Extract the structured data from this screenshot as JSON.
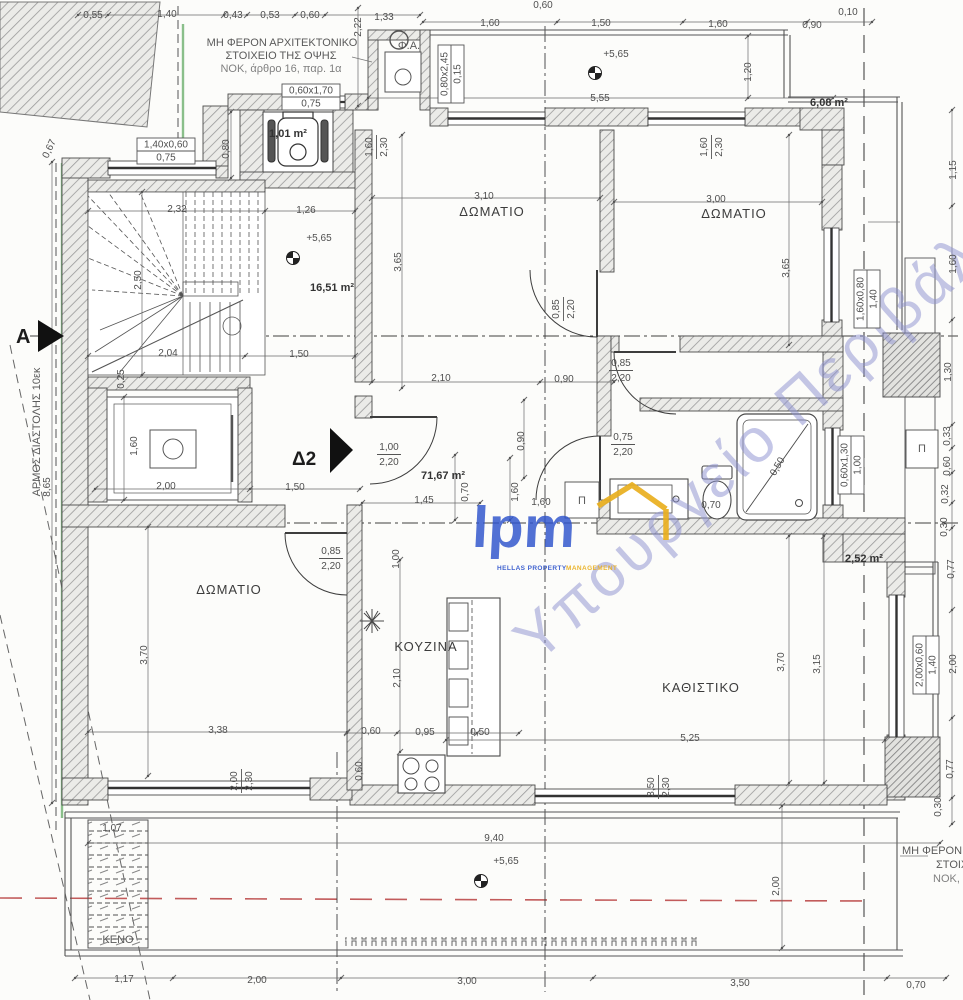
{
  "colors": {
    "line": "#474747",
    "dim_line": "#6a6a6a",
    "wall_fill": "#ececea",
    "hatch": "#9a9a9a",
    "red_dash": "#c25b5b",
    "green_boundary": "#8abf8a",
    "watermark_blue": "#8b8fd0",
    "logo_blue": "#2f55cc",
    "logo_yellow": "#e9af1e"
  },
  "plan": {
    "notes": {
      "facade_note_line1": "ΜΗ ΦΕΡΟΝ ΑΡΧΙΤΕΚΤΟΝΙΚΟ",
      "facade_note_line2": "ΣΤΟΙΧΕΙΟ ΤΗΣ ΟΨΗΣ",
      "facade_note_line3": "ΝΟΚ, άρθρο 16, παρ. 1α",
      "gas_label": "Φ.Α.",
      "void_label": "ΚΕΝΟ",
      "expansion_joint": "ΑΡΜΟΣ ΔΙΑΣΤΟΛΗΣ 10εκ",
      "br_note_line1": "ΜΗ ΦΕΡΟΝ",
      "br_note_line2": "ΣΤΟΙΧΕΙ",
      "br_note_line3": "ΝΟΚ, άρθ",
      "pi_1": "Π",
      "pi_2": "Π",
      "section_marker": "A",
      "detail_marker": "Δ2"
    },
    "rooms": [
      {
        "label": "ΔΩΜΑΤΙΟ",
        "x": 492,
        "y": 216
      },
      {
        "label": "ΔΩΜΑΤΙΟ",
        "x": 734,
        "y": 218
      },
      {
        "label": "ΔΩΜΑΤΙΟ",
        "x": 229,
        "y": 594
      },
      {
        "label": "ΚΟΥΖΙΝΑ",
        "x": 426,
        "y": 651
      },
      {
        "label": "ΚΑΘΙΣΤΙΚΟ",
        "x": 701,
        "y": 692
      }
    ],
    "areas": [
      {
        "label": "1,01 m²",
        "x": 288,
        "y": 137
      },
      {
        "label": "16,51 m²",
        "x": 332,
        "y": 291
      },
      {
        "label": "6,08 m²",
        "x": 829,
        "y": 106
      },
      {
        "label": "71,67 m²",
        "x": 443,
        "y": 479
      },
      {
        "label": "2,52 m²",
        "x": 864,
        "y": 562
      }
    ],
    "levels": [
      {
        "text": "+5,65",
        "x": 616,
        "y": 57,
        "sx": 595,
        "sy": 73
      },
      {
        "text": "+5,65",
        "x": 319,
        "y": 241,
        "sx": 293,
        "sy": 258
      },
      {
        "text": "+5,65",
        "x": 506,
        "y": 864,
        "sx": 481,
        "sy": 881
      }
    ],
    "dims": [
      {
        "v": "0,55",
        "x": 93,
        "y": 18
      },
      {
        "v": "1,40",
        "x": 167,
        "y": 17
      },
      {
        "v": "0,43",
        "x": 233,
        "y": 18
      },
      {
        "v": "0,53",
        "x": 270,
        "y": 18
      },
      {
        "v": "0,60",
        "x": 310,
        "y": 18
      },
      {
        "v": "1,33",
        "x": 384,
        "y": 20
      },
      {
        "v": "0,60",
        "x": 543,
        "y": 8
      },
      {
        "v": "1,60",
        "x": 490,
        "y": 26
      },
      {
        "v": "1,50",
        "x": 601,
        "y": 26
      },
      {
        "v": "1,60",
        "x": 718,
        "y": 27
      },
      {
        "v": "0,90",
        "x": 812,
        "y": 28
      },
      {
        "v": "0,10",
        "x": 848,
        "y": 15
      },
      {
        "v": "2,22",
        "x": 361,
        "y": 27,
        "r": -90
      },
      {
        "v": "5,55",
        "x": 600,
        "y": 101
      },
      {
        "v": "1,20",
        "x": 751,
        "y": 72,
        "r": -90
      },
      {
        "v": "0,67",
        "x": 52,
        "y": 150,
        "r": -65
      },
      {
        "v": "0,80",
        "x": 229,
        "y": 149,
        "r": -90
      },
      {
        "v": "3,10",
        "x": 484,
        "y": 199
      },
      {
        "v": "3,65",
        "x": 401,
        "y": 262,
        "r": -90
      },
      {
        "v": "3,00",
        "x": 716,
        "y": 202
      },
      {
        "v": "3,65",
        "x": 789,
        "y": 268,
        "r": -90
      },
      {
        "v": "2,32",
        "x": 177,
        "y": 212
      },
      {
        "v": "1,26",
        "x": 306,
        "y": 213
      },
      {
        "v": "2,50",
        "x": 141,
        "y": 280,
        "r": -90
      },
      {
        "v": "2,04",
        "x": 168,
        "y": 356
      },
      {
        "v": "1,50",
        "x": 299,
        "y": 357
      },
      {
        "v": "0,25",
        "x": 124,
        "y": 379,
        "r": -90
      },
      {
        "v": "2,00",
        "x": 166,
        "y": 489
      },
      {
        "v": "1,50",
        "x": 295,
        "y": 490
      },
      {
        "v": "1,60",
        "x": 137,
        "y": 446,
        "r": -90
      },
      {
        "v": "2,10",
        "x": 441,
        "y": 381
      },
      {
        "v": "0,90",
        "x": 564,
        "y": 382
      },
      {
        "v": "1,45",
        "x": 424,
        "y": 503
      },
      {
        "v": "0,90",
        "x": 524,
        "y": 441,
        "r": -90
      },
      {
        "v": "0,70",
        "x": 468,
        "y": 492,
        "r": -90
      },
      {
        "v": "1,60",
        "x": 518,
        "y": 492,
        "r": -90
      },
      {
        "v": "1,60",
        "x": 541,
        "y": 505
      },
      {
        "v": "1,00",
        "x": 399,
        "y": 559,
        "r": -90
      },
      {
        "v": "2,10",
        "x": 400,
        "y": 678,
        "r": -90
      },
      {
        "v": "0,60",
        "x": 371,
        "y": 734
      },
      {
        "v": "0,95",
        "x": 425,
        "y": 735
      },
      {
        "v": "0,50",
        "x": 480,
        "y": 735
      },
      {
        "v": "0,60",
        "x": 362,
        "y": 771,
        "r": -90
      },
      {
        "v": "3,70",
        "x": 147,
        "y": 655,
        "r": -90
      },
      {
        "v": "3,38",
        "x": 218,
        "y": 733
      },
      {
        "v": "5,25",
        "x": 690,
        "y": 741
      },
      {
        "v": "3,70",
        "x": 784,
        "y": 662,
        "r": -90
      },
      {
        "v": "3,15",
        "x": 820,
        "y": 664,
        "r": -90
      },
      {
        "v": "1,15",
        "x": 956,
        "y": 170,
        "r": -90
      },
      {
        "v": "1,60",
        "x": 956,
        "y": 264,
        "r": -90
      },
      {
        "v": "1,30",
        "x": 951,
        "y": 372,
        "r": -90
      },
      {
        "v": "0,33",
        "x": 950,
        "y": 436,
        "r": -90
      },
      {
        "v": "0,60",
        "x": 950,
        "y": 466,
        "r": -90
      },
      {
        "v": "0,32",
        "x": 948,
        "y": 494,
        "r": -90
      },
      {
        "v": "0,30",
        "x": 947,
        "y": 527,
        "r": -90
      },
      {
        "v": "0,77",
        "x": 954,
        "y": 569,
        "r": -90
      },
      {
        "v": "2,00",
        "x": 956,
        "y": 664,
        "r": -90
      },
      {
        "v": "0,77",
        "x": 953,
        "y": 769,
        "r": -90
      },
      {
        "v": "0,30",
        "x": 941,
        "y": 807,
        "r": -90
      },
      {
        "v": "9,40",
        "x": 494,
        "y": 841
      },
      {
        "v": "2,00",
        "x": 779,
        "y": 886,
        "r": -90
      },
      {
        "v": "8,65",
        "x": 50,
        "y": 487,
        "r": -90
      },
      {
        "v": "1,07",
        "x": 112,
        "y": 831
      },
      {
        "v": "1,17",
        "x": 124,
        "y": 982
      },
      {
        "v": "2,00",
        "x": 257,
        "y": 983
      },
      {
        "v": "3,00",
        "x": 467,
        "y": 984
      },
      {
        "v": "3,50",
        "x": 740,
        "y": 986
      },
      {
        "v": "0,70",
        "x": 916,
        "y": 988
      },
      {
        "v": "0,50",
        "x": 780,
        "y": 468,
        "r": -60
      },
      {
        "v": "0,70",
        "x": 711,
        "y": 508
      }
    ],
    "tags_fraction": [
      {
        "top": "1,60",
        "bot": "2,30",
        "x": 374,
        "y": 147,
        "r": -90
      },
      {
        "top": "1,60",
        "bot": "2,30",
        "x": 709,
        "y": 147,
        "r": -90
      },
      {
        "top": "0,85",
        "bot": "2,20",
        "x": 561,
        "y": 309,
        "r": -90
      },
      {
        "top": "0,85",
        "bot": "2,20",
        "x": 621,
        "y": 368,
        "r": 0
      },
      {
        "top": "0,75",
        "bot": "2,20",
        "x": 623,
        "y": 442,
        "r": 0
      },
      {
        "top": "1,00",
        "bot": "2,20",
        "x": 389,
        "y": 452,
        "r": 0
      },
      {
        "top": "0,85",
        "bot": "2,20",
        "x": 331,
        "y": 556,
        "r": 0
      },
      {
        "top": "3,50",
        "bot": "2,30",
        "x": 656,
        "y": 787,
        "r": -90
      },
      {
        "top": "2,00",
        "bot": "2,30",
        "x": 239,
        "y": 781,
        "r": -90
      }
    ],
    "tags_box": [
      {
        "top": "0,60x1,70",
        "bot": "0,75",
        "x": 311,
        "y": 96,
        "r": 0
      },
      {
        "top": "1,40x0,60",
        "bot": "0,75",
        "x": 166,
        "y": 150,
        "r": 0
      },
      {
        "top": "0,80x2,45",
        "bot": "0,15",
        "x": 450,
        "y": 74,
        "r": -90
      },
      {
        "top": "1,60x0,80",
        "bot": "1,40",
        "x": 866,
        "y": 299,
        "r": -90
      },
      {
        "top": "0,60x1,30",
        "bot": "1,00",
        "x": 850,
        "y": 465,
        "r": -90
      },
      {
        "top": "2,00x0,60",
        "bot": "1,40",
        "x": 925,
        "y": 665,
        "r": -90
      }
    ],
    "watermark": {
      "logo": "lpm",
      "tagline_a": "HELLAS PROPERTY",
      "tagline_b": "MANAGEMENT",
      "ministry": "Υπουργείο Περιβάλ"
    }
  }
}
